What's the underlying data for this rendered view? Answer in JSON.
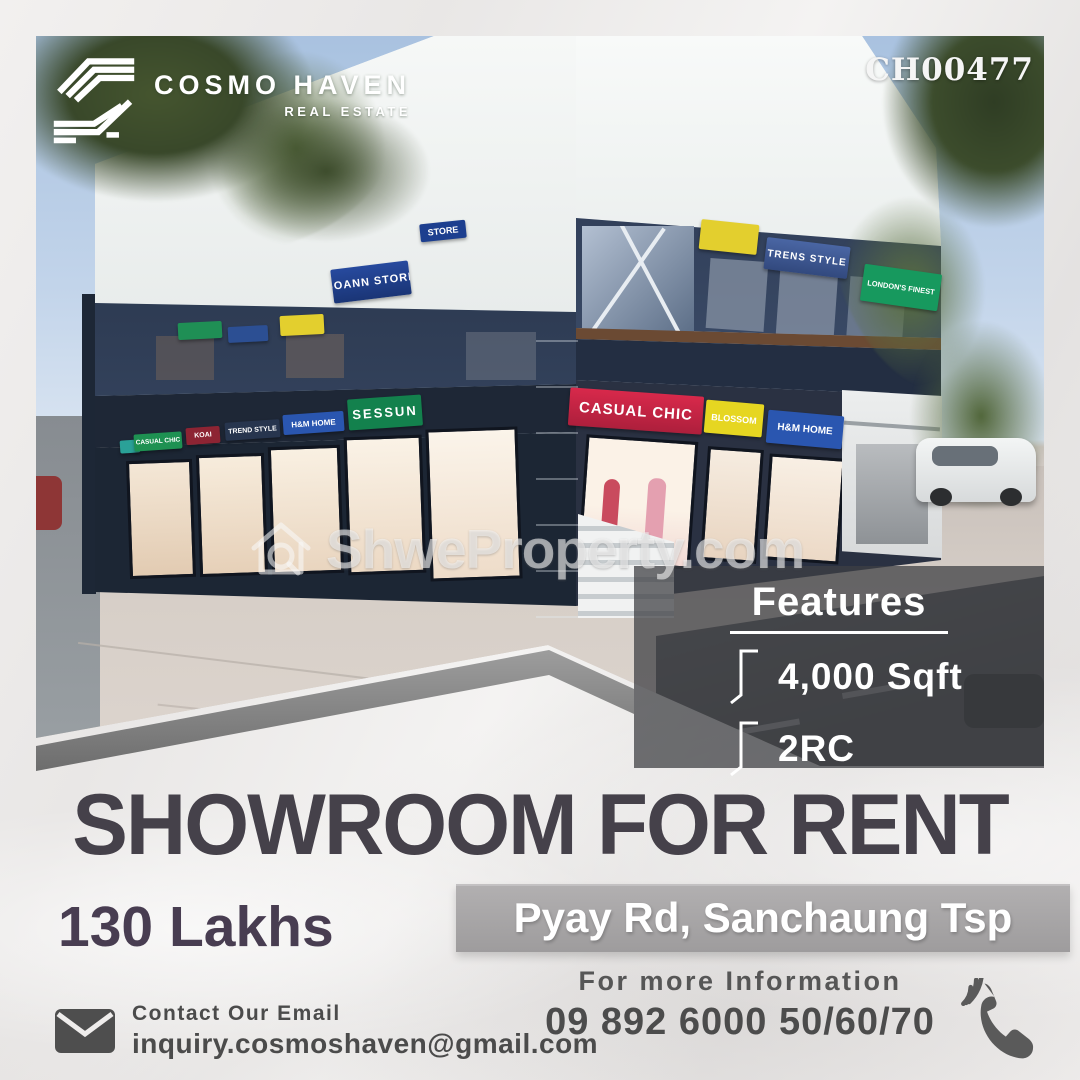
{
  "brand": {
    "name": "COSMO HAVEN",
    "tagline": "REAL ESTATE"
  },
  "listing_id": "CH00477",
  "watermark": {
    "text": "ShweProperty.com"
  },
  "photo": {
    "signs": {
      "upper_left_main": "SOANN STORE",
      "upper_left_fragment": "STORE",
      "upper_right_blue": "TRENS STYLE",
      "upper_right_green": "LONDON'S FINEST",
      "ground_right": [
        "CASUAL CHIC",
        "BLOSSOM",
        "H&M HOME"
      ],
      "ground_left": [
        "CASUAL CHIC",
        "KOAI",
        "TREND STYLE",
        "H&M HOME",
        "SESSUN"
      ]
    }
  },
  "features": {
    "title": "Features",
    "items": [
      "4,000 Sqft",
      "2RC"
    ]
  },
  "headline": "SHOWROOM FOR RENT",
  "price": "130 Lakhs",
  "location": "Pyay Rd, Sanchaung Tsp",
  "contact": {
    "email_label": "Contact Our Email",
    "email": "inquiry.cosmoshaven@gmail.com",
    "info_label": "For more Information",
    "phone": "09 892 6000 50/60/70"
  },
  "colors": {
    "headline": "#45414a",
    "price": "#483d51",
    "banner_gray": "#a7a5a6",
    "sign_red": "#c8284a",
    "sign_yellow": "#e6d621",
    "sign_blue": "#2a56b0",
    "sign_green": "#13814d",
    "building_navy": "#27334a"
  }
}
